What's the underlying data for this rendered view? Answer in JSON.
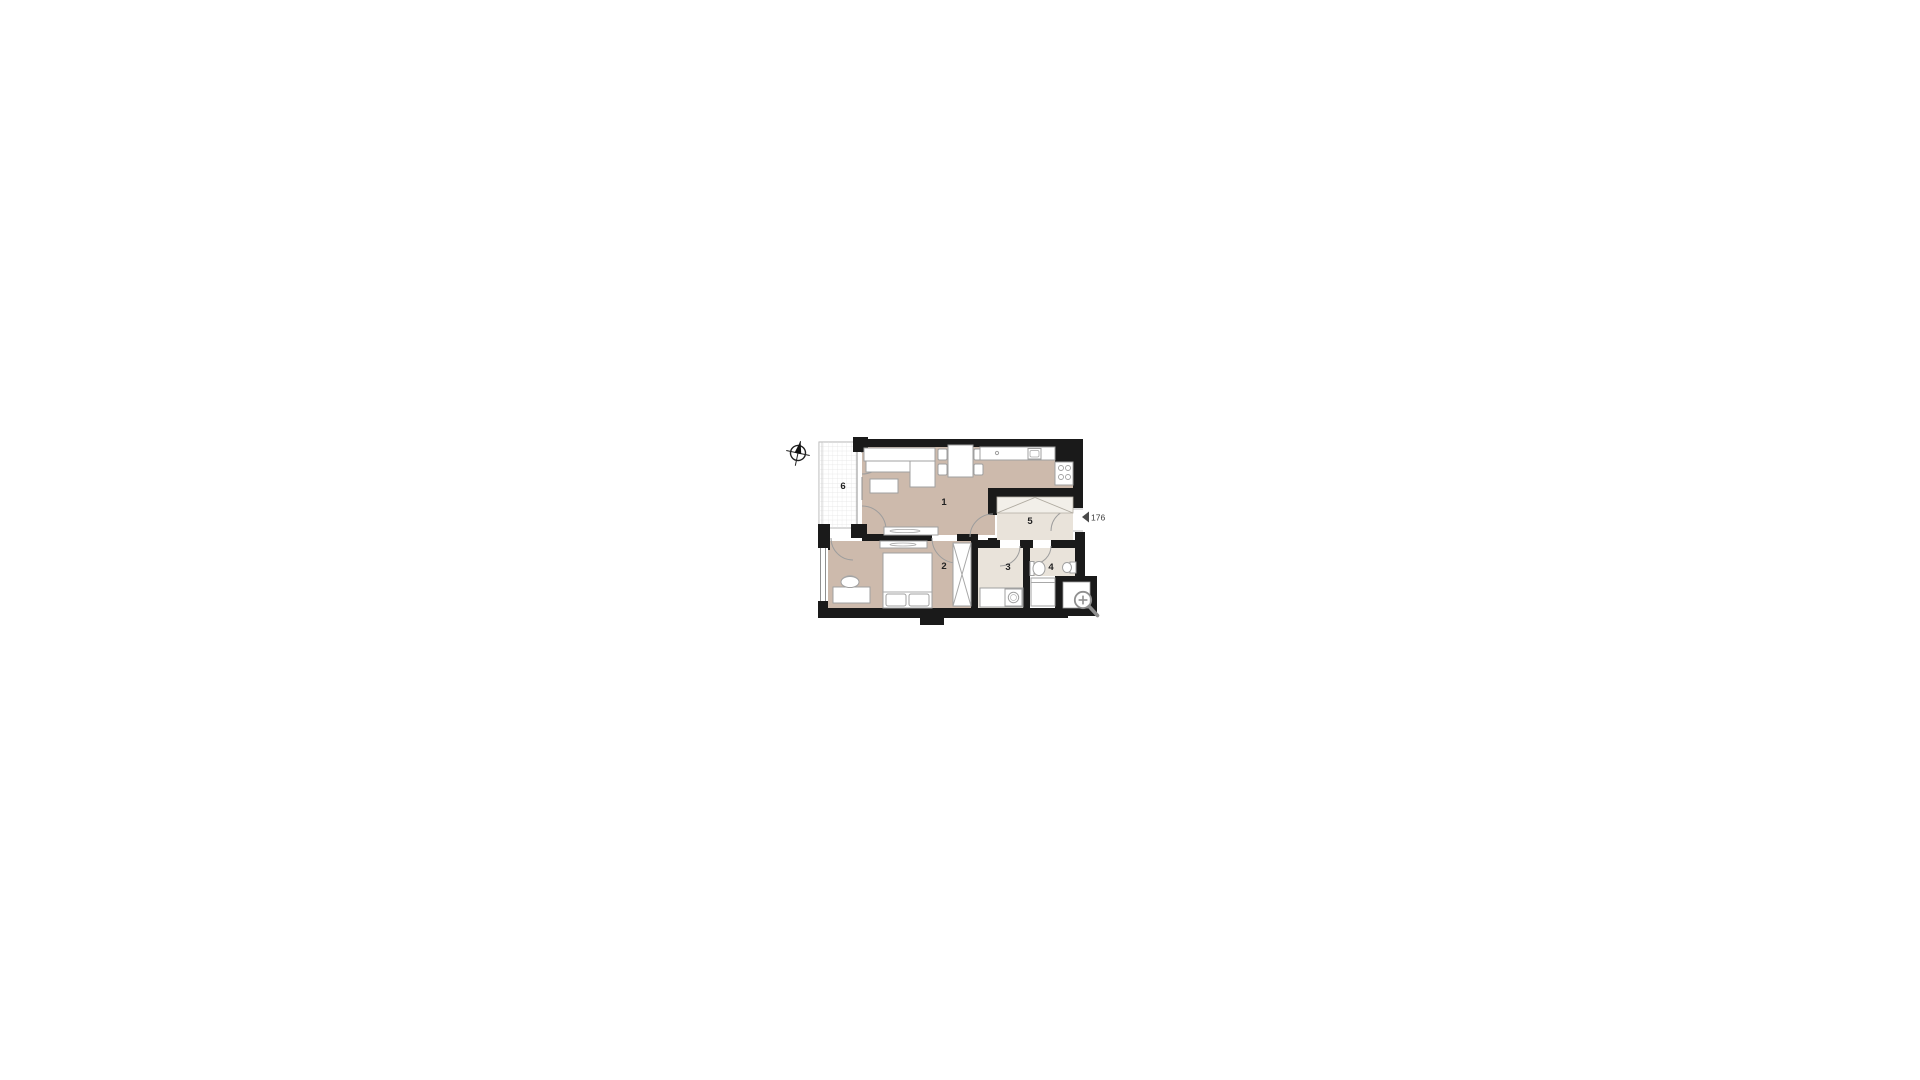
{
  "page": {
    "background_color": "#ffffff",
    "content": "apartment floor plan drawing"
  },
  "floor_plan": {
    "unit_number": "176",
    "rooms": [
      {
        "number": "1",
        "name": "living-room-with-kitchen"
      },
      {
        "number": "2",
        "name": "bedroom"
      },
      {
        "number": "3",
        "name": "bathroom"
      },
      {
        "number": "4",
        "name": "wc"
      },
      {
        "number": "5",
        "name": "hallway"
      },
      {
        "number": "6",
        "name": "loggia"
      }
    ],
    "colors": {
      "walls": "#1a1a1a",
      "main_room_fill": "#cdbaac",
      "service_room_fill": "#e9e3da",
      "closet_fill": "#f2efe9",
      "furniture_stroke": "#a0a0a0",
      "icon_gray": "#8f8f8f"
    },
    "icons": {
      "compass": "north-compass",
      "magnifier": "zoom-in",
      "entrance_marker": "entrance-arrow"
    }
  }
}
